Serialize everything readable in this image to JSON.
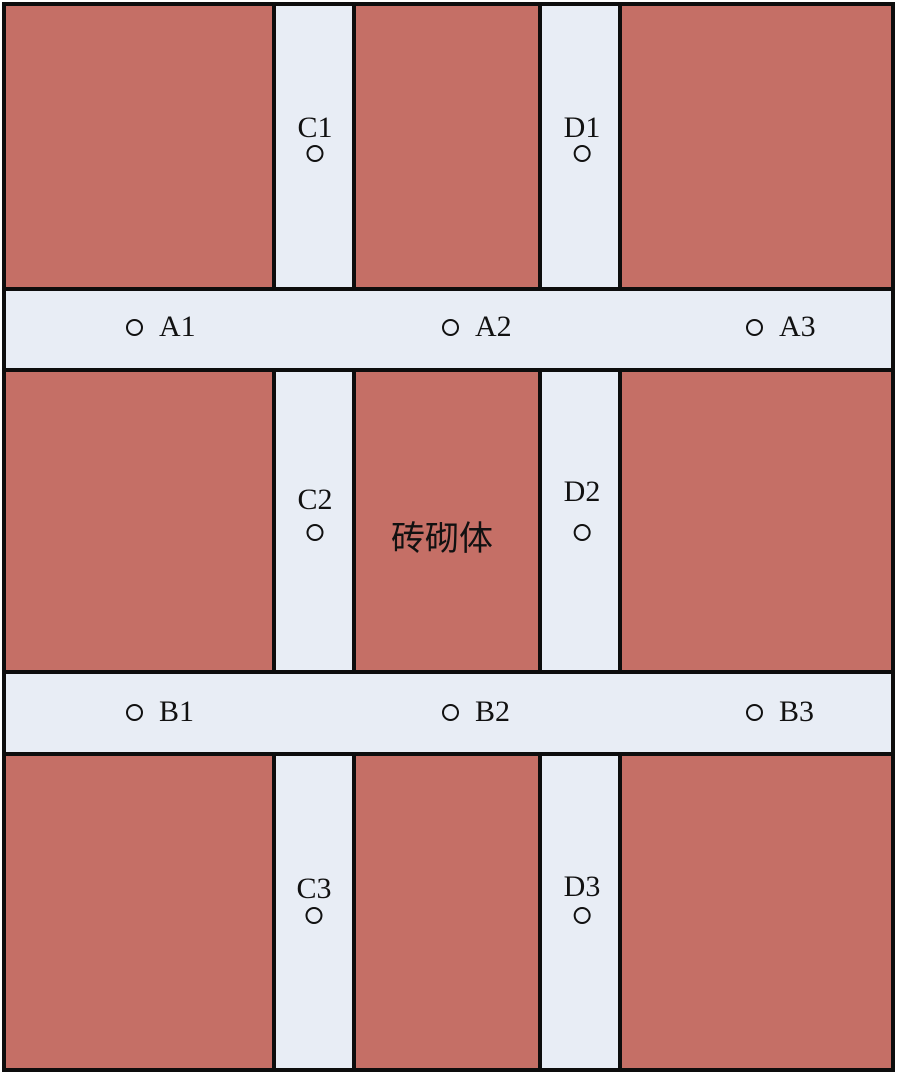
{
  "diagram": {
    "type": "masonry-wall-measurement-layout",
    "center_label": "砖砌体",
    "colors": {
      "masonry": "#c56f66",
      "band": "#e8edf5",
      "outline": "#0d0d0d"
    },
    "points": [
      {
        "label": "A1"
      },
      {
        "label": "A2"
      },
      {
        "label": "A3"
      },
      {
        "label": "B1"
      },
      {
        "label": "B2"
      },
      {
        "label": "B3"
      },
      {
        "label": "C1"
      },
      {
        "label": "C2"
      },
      {
        "label": "C3"
      },
      {
        "label": "D1"
      },
      {
        "label": "D2"
      },
      {
        "label": "D3"
      }
    ]
  }
}
